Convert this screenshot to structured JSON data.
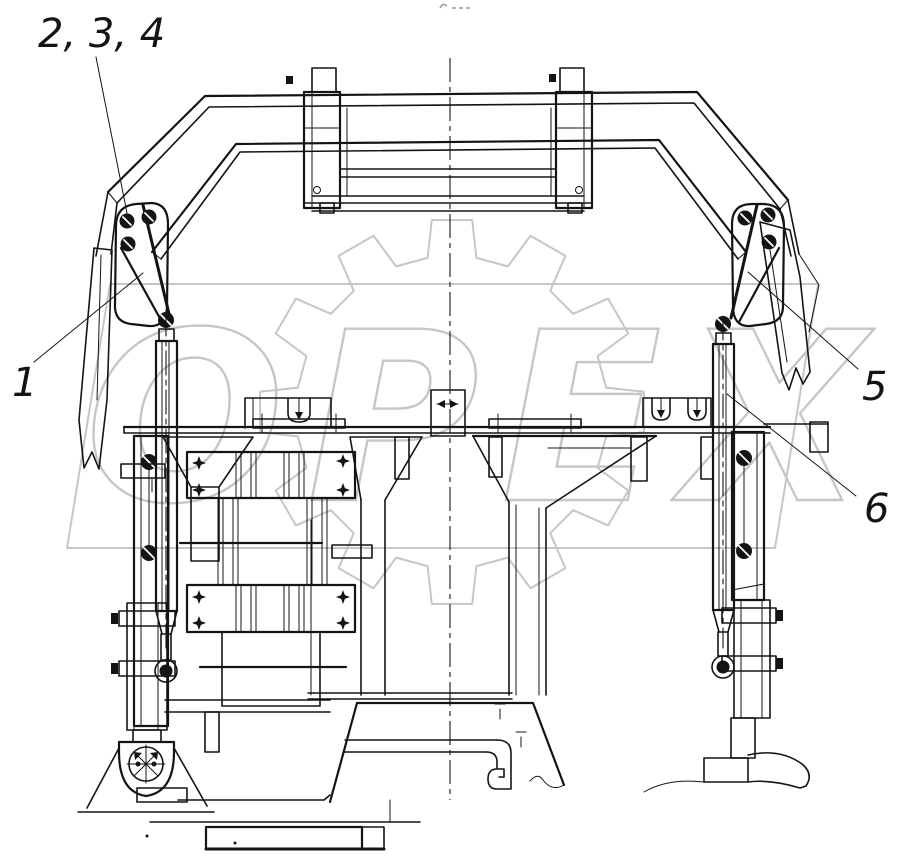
{
  "figure": {
    "background": "#ffffff",
    "ink_color": "#141414",
    "watermark": {
      "text": "OPEX",
      "color": "#c6c6c6"
    },
    "callouts": [
      {
        "id": "gusset-bolts",
        "label": "2, 3, 4"
      },
      {
        "id": "left-gusset-plate",
        "label": "1"
      },
      {
        "id": "right-gusset-plate",
        "label": "5"
      },
      {
        "id": "right-gas-strut",
        "label": "6"
      }
    ]
  }
}
